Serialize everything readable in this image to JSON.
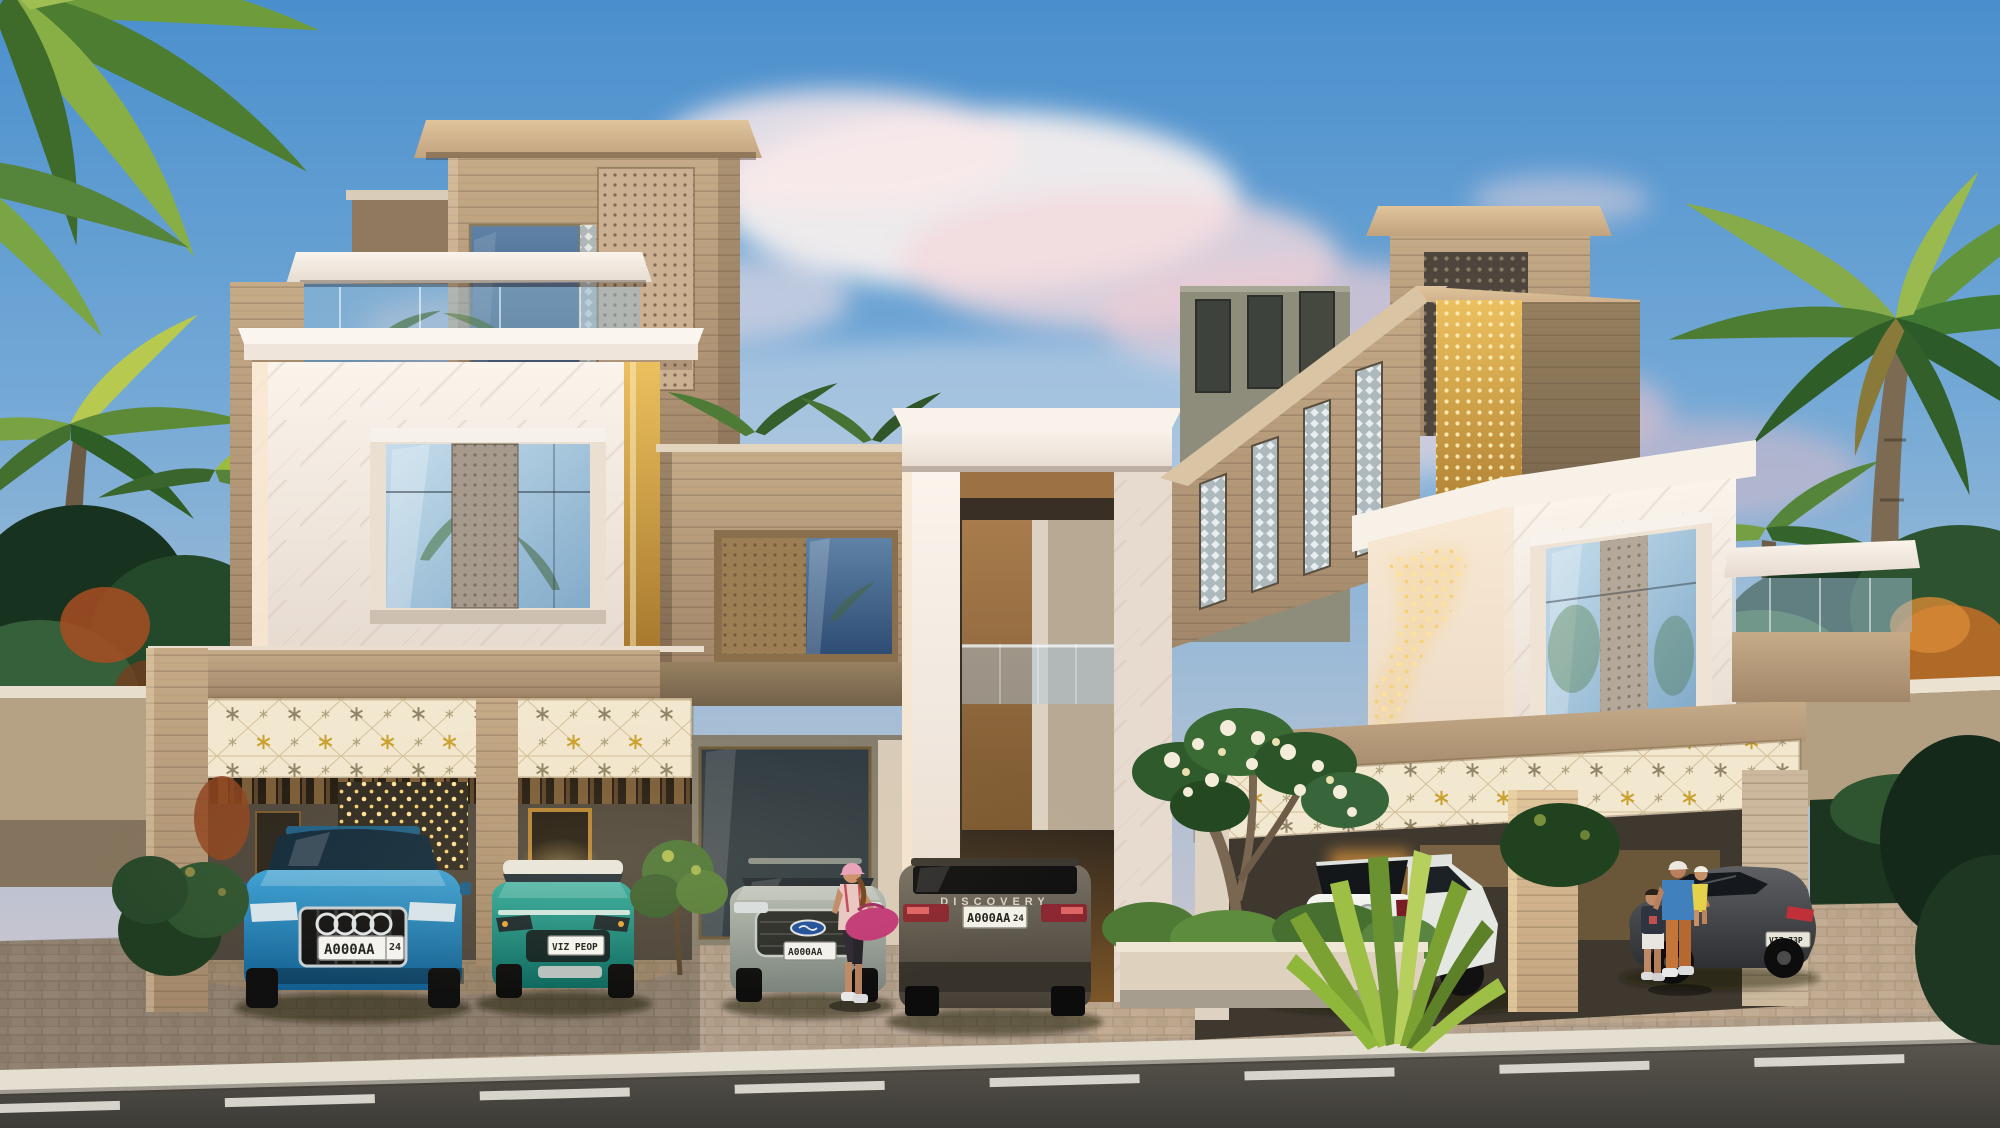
{
  "scene": {
    "description": "Dusk architectural rendering of a modern marble, travertine and wood villa row with palm trees, lit perforated screens, six parked cars and residents",
    "time_of_day": "dusk",
    "palette": {
      "sky_top": "#4a8fcd",
      "sky_horizon": "#d9cdd0",
      "cloud_pink": "#f0d4d8",
      "marble": "#f5efe7",
      "travertine": "#b99d7c",
      "wood": "#9a7246",
      "glow_warm": "#ffdf8e",
      "palm_green": "#3f7a3a",
      "asphalt": "#4a4843",
      "paver": "#b5a28f",
      "curb": "#e5dfd2"
    }
  },
  "buildings": {
    "left_villa": {
      "features": "travertine tower with perforated screen, white marble window box, rooftop glass terrace, star-pattern lit frieze over carport"
    },
    "center": {
      "features": "two-storey white marble portal with wood-lined reveal and glass balcony"
    },
    "right_villa": {
      "features": "slanted travertine volume with slot windows, gold perforated corner, white marble box with glowing lattice, star-pattern lit frieze"
    }
  },
  "cars": [
    {
      "id": "audi-q8-suv",
      "body": "SUV front view",
      "color_name": "blue",
      "color_hex": "#1f7fb8",
      "brand_mark": "audi-rings-icon",
      "plate": "A000AA",
      "plate_region": "24"
    },
    {
      "id": "compact-crossover",
      "body": "crossover front view",
      "color_name": "teal",
      "color_hex": "#13877b",
      "roof": "white",
      "plate": "VIZ PEOP"
    },
    {
      "id": "ford-suv",
      "body": "SUV front view",
      "color_name": "silver grey",
      "color_hex": "#95a098",
      "brand_mark": "ford-logo-icon",
      "plate": "A000AA"
    },
    {
      "id": "land-rover-discovery",
      "body": "SUV rear view",
      "color_name": "grey brown",
      "color_hex": "#57514a",
      "badge": "DISCOVERY",
      "plate": "A000AA",
      "plate_region": "24"
    },
    {
      "id": "mazda-crossover",
      "body": "crossover rear three-quarter view",
      "color_name": "white",
      "color_hex": "#eceeea",
      "brand_mark": "mazda-logo-icon",
      "plate": "A000AA 24"
    },
    {
      "id": "fastback-sedan",
      "body": "sedan side view",
      "color_name": "dark grey",
      "color_hex": "#3f4144",
      "plate": "VIZ 73P"
    }
  ],
  "people": [
    {
      "id": "woman-gym-bag",
      "detail": "woman in pink cap carrying magenta duffel bag"
    },
    {
      "id": "man-with-child",
      "detail": "man in blue t-shirt and orange trousers carrying toddler in yellow"
    },
    {
      "id": "boy",
      "detail": "boy in dark t-shirt and white shorts"
    }
  ],
  "vegetation": "palm trees, frangipani tree with white blossoms, agave plant, clipped hedges",
  "road": {
    "marking": "dashed white center line"
  }
}
